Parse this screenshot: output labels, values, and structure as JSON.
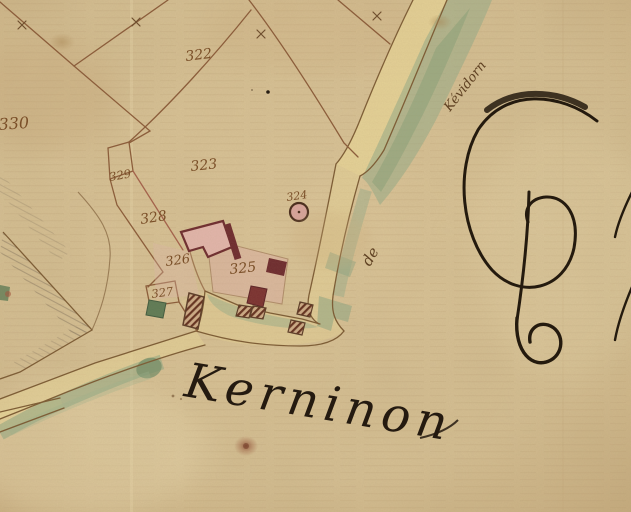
{
  "map": {
    "type": "historical-cadastral-map",
    "place_name": "Kerninon",
    "road_text": {
      "preposition": "de",
      "destination": "Kévidorn"
    },
    "margin_text": "Pré",
    "parcel_numbers": {
      "p322": "322",
      "p323": "323",
      "p324": "324",
      "p325": "325",
      "p326": "326",
      "p327": "327",
      "p328": "328",
      "p329": "329",
      "p330": "330"
    },
    "colors": {
      "paper": "#d6c094",
      "ink_dark": "#241a0e",
      "line_brown": "#7b5a33",
      "line_red": "#a4604a",
      "number_brown": "#7a4f28",
      "building_red": "#6d2a2e",
      "building_pink": "#e2b5ab",
      "road_yellow": "#e8d697",
      "vegetation_green": "#93ab89",
      "green_building": "#5d7a55",
      "hatch_gray": "#8d7c63"
    }
  }
}
